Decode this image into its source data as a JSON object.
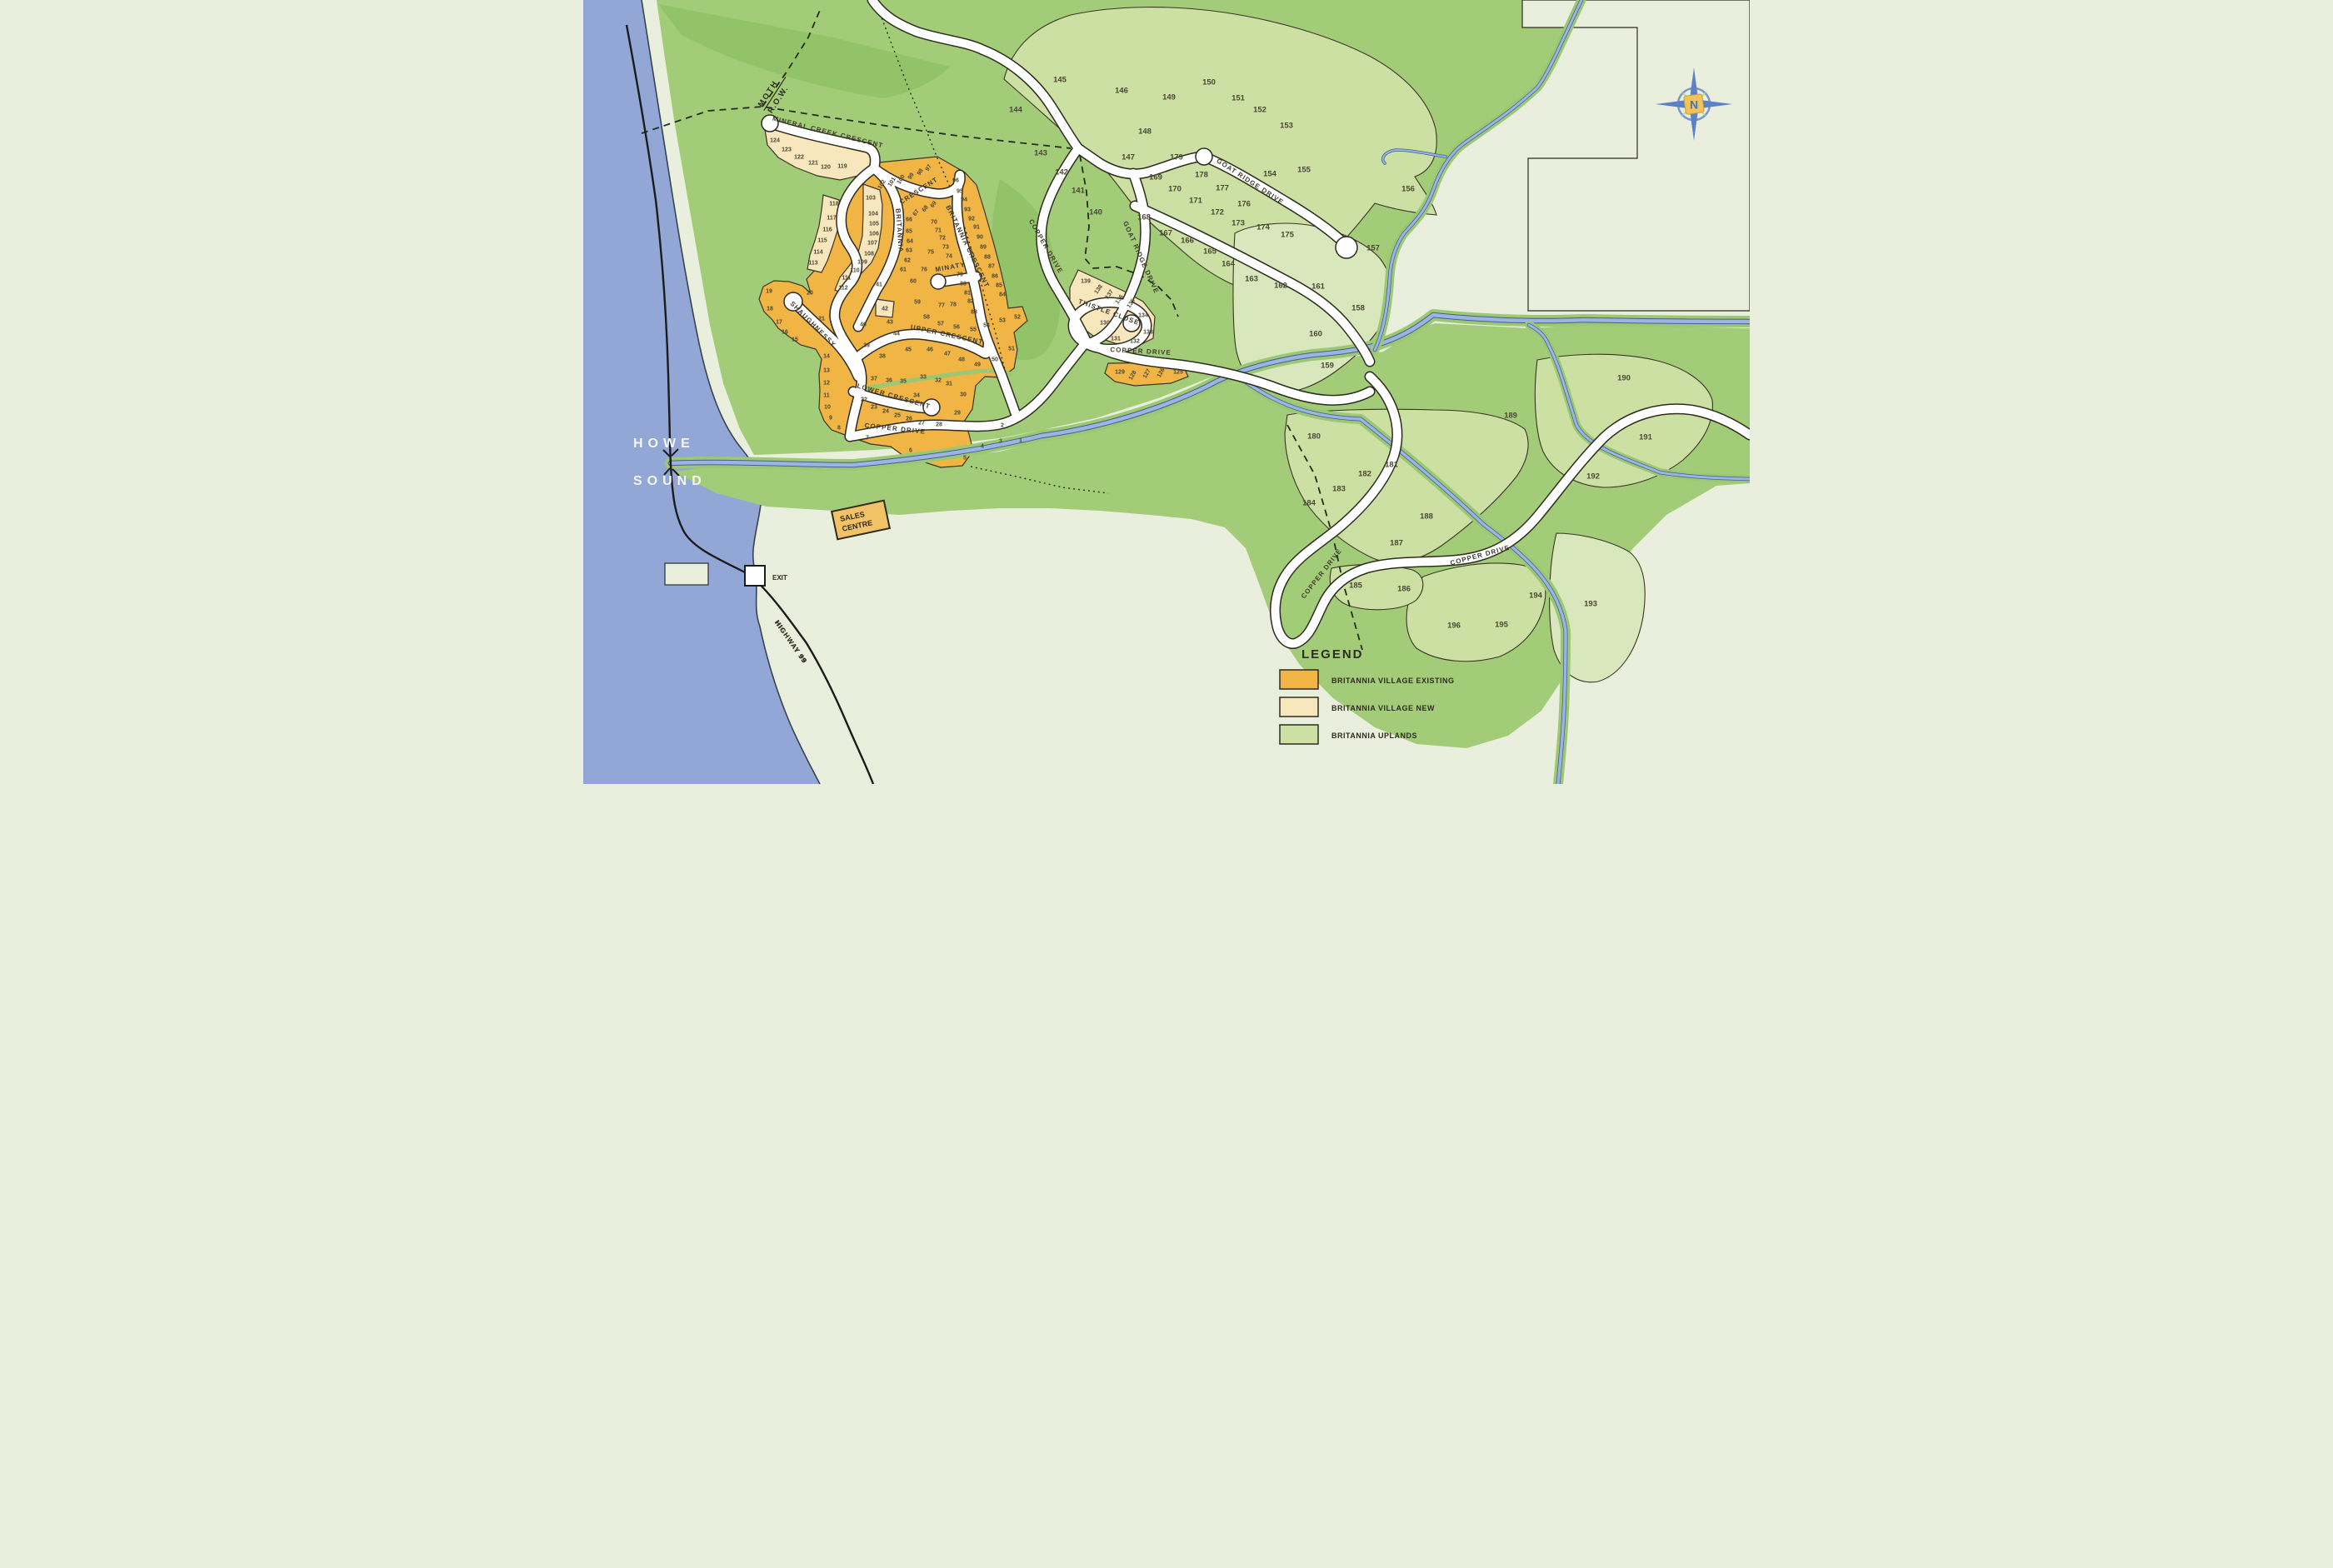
{
  "map_title": "Britannia development lot map",
  "water": {
    "name_line1": "HOWE",
    "name_line2": "SOUND",
    "color": "#92a7d6"
  },
  "markers": {
    "exit_label": "EXIT",
    "highway_label": "HIGHWAY 99",
    "moth_row_line1": "MOTH",
    "moth_row_line2": "R.O.W.",
    "sales_centre_line1": "SALES",
    "sales_centre_line2": "CENTRE",
    "compass_letter": "N"
  },
  "legend": {
    "title": "LEGEND",
    "items": [
      {
        "label": "BRITANNIA VILLAGE EXISTING",
        "color": "#f0b545"
      },
      {
        "label": "BRITANNIA VILLAGE NEW",
        "color": "#f8e6bd"
      },
      {
        "label": "BRITANNIA UPLANDS",
        "color": "#cbe0a2"
      }
    ]
  },
  "colors": {
    "background_pale": "#e9efdc",
    "upland_green": "#a3cc78",
    "dark_green": "#92c368",
    "lot_green": "#cbe0a2",
    "village_existing": "#f0b545",
    "village_new": "#f8e6bd",
    "road_white": "#ffffff",
    "road_casing": "#2e2b20",
    "creek_blue": "#9db4e2",
    "creek_edge": "#41608f",
    "label_dark": "#4c4735"
  },
  "road_labels": [
    [
      "MINERAL CREEK CRESCENT",
      293,
      161,
      14
    ],
    [
      "CRESCENT",
      404,
      231,
      -33
    ],
    [
      "BRITANNIA",
      377,
      277,
      86
    ],
    [
      "BRITANNIA CRESCENT",
      459,
      297,
      64
    ],
    [
      "MINATY",
      441,
      323,
      -10
    ],
    [
      "UPPER CRESCENT",
      436,
      404,
      12
    ],
    [
      "LOWER CRESCENT",
      372,
      478,
      16
    ],
    [
      "COPPER DRIVE",
      374,
      517,
      6
    ],
    [
      "SHAUGHNESSY",
      274,
      391,
      45
    ],
    [
      "COPPER DRIVE",
      553,
      297,
      60
    ],
    [
      "GOAT RIDGE DRIVE",
      667,
      310,
      66
    ],
    [
      "THISTLE CLOSE",
      630,
      377,
      20
    ],
    [
      "COPPER DRIVE",
      669,
      424,
      3
    ],
    [
      "GOAT RIDGE DRIVE",
      799,
      220,
      33
    ],
    [
      "COPPER DRIVE",
      888,
      690,
      -52
    ],
    [
      "COPPER DRIVE",
      1077,
      669,
      -15
    ],
    [
      "HIGHWAY 99",
      247,
      772,
      55
    ]
  ],
  "lots": [
    [
      1,
      525,
      528,
      "e",
      0
    ],
    [
      2,
      503,
      510,
      "e",
      0
    ],
    [
      3,
      501,
      529,
      "e",
      0
    ],
    [
      4,
      479,
      535,
      "e",
      0
    ],
    [
      5,
      458,
      549,
      "e",
      0
    ],
    [
      6,
      393,
      540,
      "e",
      0
    ],
    [
      7,
      341,
      525,
      "e",
      0
    ],
    [
      8,
      307,
      513,
      "e",
      0
    ],
    [
      9,
      297,
      501,
      "e",
      0
    ],
    [
      10,
      293,
      488,
      "e",
      0
    ],
    [
      11,
      292,
      474,
      "e",
      0
    ],
    [
      12,
      292,
      459,
      "e",
      0
    ],
    [
      13,
      292,
      444,
      "e",
      0
    ],
    [
      14,
      292,
      427,
      "e",
      0
    ],
    [
      15,
      254,
      407,
      "e",
      0
    ],
    [
      16,
      242,
      398,
      "e",
      0
    ],
    [
      17,
      235,
      386,
      "e",
      0
    ],
    [
      18,
      224,
      370,
      "e",
      0
    ],
    [
      19,
      223,
      349,
      "e",
      0
    ],
    [
      20,
      272,
      351,
      "e",
      0
    ],
    [
      21,
      286,
      382,
      "e",
      0
    ],
    [
      22,
      337,
      479,
      "e",
      0
    ],
    [
      23,
      349,
      488,
      "e",
      0
    ],
    [
      24,
      363,
      493,
      "e",
      0
    ],
    [
      25,
      377,
      498,
      "e",
      0
    ],
    [
      26,
      391,
      502,
      "e",
      0
    ],
    [
      27,
      406,
      507,
      "e",
      0
    ],
    [
      28,
      427,
      509,
      "e",
      0
    ],
    [
      29,
      449,
      495,
      "e",
      0
    ],
    [
      30,
      456,
      473,
      "e",
      0
    ],
    [
      31,
      439,
      460,
      "e",
      0
    ],
    [
      32,
      426,
      456,
      "e",
      0
    ],
    [
      33,
      408,
      452,
      "e",
      0
    ],
    [
      34,
      400,
      474,
      "e",
      0
    ],
    [
      35,
      384,
      457,
      "e",
      0
    ],
    [
      36,
      367,
      456,
      "e",
      0
    ],
    [
      37,
      349,
      454,
      "e",
      0
    ],
    [
      38,
      359,
      427,
      "e",
      0
    ],
    [
      39,
      340,
      414,
      "e",
      0
    ],
    [
      40,
      336,
      389,
      "e",
      0
    ],
    [
      41,
      355,
      341,
      "e",
      0
    ],
    [
      42,
      362,
      370,
      "n",
      0
    ],
    [
      43,
      368,
      386,
      "e",
      0
    ],
    [
      44,
      376,
      400,
      "e",
      0
    ],
    [
      45,
      390,
      419,
      "e",
      0
    ],
    [
      46,
      416,
      419,
      "e",
      0
    ],
    [
      47,
      437,
      424,
      "e",
      0
    ],
    [
      48,
      454,
      431,
      "e",
      0
    ],
    [
      49,
      473,
      437,
      "e",
      0
    ],
    [
      50,
      494,
      431,
      "e",
      0
    ],
    [
      51,
      514,
      418,
      "e",
      0
    ],
    [
      52,
      521,
      380,
      "e",
      0
    ],
    [
      53,
      503,
      384,
      "e",
      0
    ],
    [
      54,
      484,
      390,
      "e",
      0
    ],
    [
      55,
      468,
      395,
      "e",
      0
    ],
    [
      56,
      448,
      392,
      "e",
      0
    ],
    [
      57,
      429,
      388,
      "e",
      0
    ],
    [
      58,
      412,
      380,
      "e",
      0
    ],
    [
      59,
      401,
      362,
      "e",
      0
    ],
    [
      60,
      396,
      337,
      "e",
      0
    ],
    [
      61,
      384,
      323,
      "e",
      0
    ],
    [
      62,
      389,
      312,
      "e",
      0
    ],
    [
      63,
      391,
      300,
      "e",
      0
    ],
    [
      64,
      392,
      289,
      "e",
      0
    ],
    [
      65,
      391,
      277,
      "e",
      0
    ],
    [
      66,
      391,
      263,
      "e",
      0
    ],
    [
      67,
      401,
      254,
      "e",
      -55
    ],
    [
      68,
      412,
      249,
      "e",
      -55
    ],
    [
      69,
      422,
      244,
      "e",
      -55
    ],
    [
      70,
      421,
      266,
      "e",
      0
    ],
    [
      71,
      426,
      276,
      "e",
      0
    ],
    [
      72,
      431,
      285,
      "e",
      0
    ],
    [
      73,
      435,
      296,
      "e",
      0
    ],
    [
      74,
      439,
      307,
      "e",
      0
    ],
    [
      75,
      417,
      302,
      "e",
      0
    ],
    [
      76,
      409,
      323,
      "e",
      0
    ],
    [
      77,
      430,
      366,
      "e",
      0
    ],
    [
      78,
      444,
      365,
      "e",
      0
    ],
    [
      79,
      452,
      329,
      "e",
      0
    ],
    [
      80,
      456,
      340,
      "e",
      0
    ],
    [
      81,
      461,
      351,
      "e",
      0
    ],
    [
      82,
      465,
      361,
      "e",
      0
    ],
    [
      83,
      469,
      374,
      "e",
      0
    ],
    [
      84,
      503,
      353,
      "e",
      0
    ],
    [
      85,
      499,
      342,
      "e",
      0
    ],
    [
      86,
      494,
      331,
      "e",
      0
    ],
    [
      87,
      490,
      319,
      "e",
      0
    ],
    [
      88,
      485,
      308,
      "e",
      0
    ],
    [
      89,
      480,
      296,
      "e",
      0
    ],
    [
      90,
      476,
      284,
      "e",
      0
    ],
    [
      91,
      472,
      272,
      "e",
      0
    ],
    [
      92,
      466,
      262,
      "e",
      0
    ],
    [
      93,
      461,
      251,
      "e",
      0
    ],
    [
      94,
      457,
      239,
      "e",
      0
    ],
    [
      95,
      452,
      229,
      "e",
      0
    ],
    [
      96,
      447,
      216,
      "e",
      0
    ],
    [
      97,
      416,
      200,
      "e",
      -58
    ],
    [
      98,
      406,
      205,
      "e",
      -58
    ],
    [
      99,
      395,
      210,
      "e",
      -58
    ],
    [
      100,
      383,
      214,
      "e",
      -58
    ],
    [
      101,
      372,
      217,
      "e",
      -58
    ],
    [
      102,
      360,
      220,
      "e",
      -58
    ],
    [
      103,
      345,
      237,
      "n",
      0
    ],
    [
      104,
      348,
      256,
      "n",
      0
    ],
    [
      105,
      349,
      268,
      "n",
      0
    ],
    [
      106,
      349,
      280,
      "n",
      0
    ],
    [
      107,
      347,
      291,
      "n",
      0
    ],
    [
      108,
      343,
      304,
      "n",
      0
    ],
    [
      109,
      335,
      314,
      "n",
      0
    ],
    [
      110,
      326,
      324,
      "n",
      0
    ],
    [
      111,
      316,
      333,
      "n",
      0
    ],
    [
      112,
      312,
      345,
      "n",
      0
    ],
    [
      113,
      276,
      315,
      "n",
      0
    ],
    [
      114,
      282,
      302,
      "n",
      0
    ],
    [
      115,
      287,
      288,
      "n",
      0
    ],
    [
      116,
      293,
      275,
      "n",
      0
    ],
    [
      117,
      298,
      261,
      "n",
      0
    ],
    [
      118,
      301,
      244,
      "n",
      0
    ],
    [
      119,
      311,
      199,
      "n",
      0
    ],
    [
      120,
      291,
      200,
      "n",
      0
    ],
    [
      121,
      276,
      195,
      "n",
      0
    ],
    [
      122,
      259,
      188,
      "n",
      0
    ],
    [
      123,
      244,
      179,
      "n",
      0
    ],
    [
      124,
      230,
      168,
      "n",
      0
    ],
    [
      125,
      714,
      446,
      "e",
      0
    ],
    [
      126,
      695,
      446,
      "e",
      -60
    ],
    [
      127,
      678,
      447,
      "e",
      -60
    ],
    [
      128,
      661,
      449,
      "e",
      -60
    ],
    [
      129,
      644,
      446,
      "e",
      0
    ],
    [
      130,
      626,
      387,
      "n",
      0
    ],
    [
      131,
      639,
      406,
      "n",
      0
    ],
    [
      132,
      662,
      409,
      "n",
      0
    ],
    [
      133,
      678,
      398,
      "n",
      0
    ],
    [
      134,
      672,
      378,
      "n",
      0
    ],
    [
      135,
      659,
      363,
      "n",
      -55
    ],
    [
      136,
      645,
      358,
      "n",
      -55
    ],
    [
      137,
      633,
      352,
      "n",
      -55
    ],
    [
      138,
      620,
      346,
      "n",
      -55
    ],
    [
      139,
      603,
      337,
      "n",
      0
    ],
    [
      140,
      615,
      254,
      "u",
      0
    ],
    [
      141,
      594,
      228,
      "u",
      0
    ],
    [
      142,
      574,
      206,
      "u",
      0
    ],
    [
      143,
      549,
      183,
      "u",
      0
    ],
    [
      144,
      519,
      131,
      "u",
      0
    ],
    [
      145,
      572,
      95,
      "u",
      0
    ],
    [
      146,
      646,
      108,
      "u",
      0
    ],
    [
      147,
      654,
      188,
      "u",
      0
    ],
    [
      148,
      674,
      157,
      "u",
      0
    ],
    [
      149,
      703,
      116,
      "u",
      0
    ],
    [
      150,
      751,
      98,
      "u",
      0
    ],
    [
      151,
      786,
      117,
      "u",
      0
    ],
    [
      152,
      812,
      131,
      "u",
      0
    ],
    [
      153,
      844,
      150,
      "u",
      0
    ],
    [
      154,
      824,
      208,
      "u",
      0
    ],
    [
      155,
      865,
      203,
      "u",
      0
    ],
    [
      156,
      990,
      226,
      "u",
      0
    ],
    [
      157,
      948,
      297,
      "u",
      0
    ],
    [
      158,
      930,
      369,
      "u",
      0
    ],
    [
      159,
      893,
      438,
      "u",
      0
    ],
    [
      160,
      879,
      400,
      "u",
      0
    ],
    [
      161,
      882,
      343,
      "u",
      0
    ],
    [
      162,
      837,
      342,
      "u",
      0
    ],
    [
      163,
      802,
      334,
      "u",
      0
    ],
    [
      164,
      774,
      316,
      "u",
      0
    ],
    [
      165,
      752,
      301,
      "u",
      0
    ],
    [
      166,
      725,
      288,
      "u",
      0
    ],
    [
      167,
      699,
      279,
      "u",
      0
    ],
    [
      168,
      673,
      260,
      "u",
      0
    ],
    [
      169,
      687,
      212,
      "u",
      0
    ],
    [
      170,
      710,
      226,
      "u",
      0
    ],
    [
      171,
      735,
      240,
      "u",
      0
    ],
    [
      172,
      761,
      254,
      "u",
      0
    ],
    [
      173,
      786,
      267,
      "u",
      0
    ],
    [
      174,
      816,
      272,
      "u",
      0
    ],
    [
      175,
      845,
      281,
      "u",
      0
    ],
    [
      176,
      793,
      244,
      "u",
      0
    ],
    [
      177,
      767,
      225,
      "u",
      0
    ],
    [
      178,
      742,
      209,
      "u",
      0
    ],
    [
      179,
      712,
      188,
      "u",
      0
    ],
    [
      180,
      877,
      523,
      "u",
      0
    ],
    [
      181,
      970,
      557,
      "u",
      0
    ],
    [
      182,
      938,
      568,
      "u",
      0
    ],
    [
      183,
      907,
      586,
      "u",
      0
    ],
    [
      184,
      871,
      603,
      "u",
      0
    ],
    [
      185,
      927,
      702,
      "u",
      0
    ],
    [
      186,
      985,
      706,
      "u",
      0
    ],
    [
      187,
      976,
      651,
      "u",
      0
    ],
    [
      188,
      1012,
      619,
      "u",
      0
    ],
    [
      189,
      1113,
      498,
      "u",
      0
    ],
    [
      190,
      1249,
      453,
      "u",
      0
    ],
    [
      191,
      1275,
      524,
      "u",
      0
    ],
    [
      192,
      1212,
      571,
      "u",
      0
    ],
    [
      193,
      1209,
      724,
      "u",
      0
    ],
    [
      194,
      1143,
      714,
      "u",
      0
    ],
    [
      195,
      1102,
      749,
      "u",
      0
    ],
    [
      196,
      1045,
      750,
      "u",
      0
    ]
  ]
}
